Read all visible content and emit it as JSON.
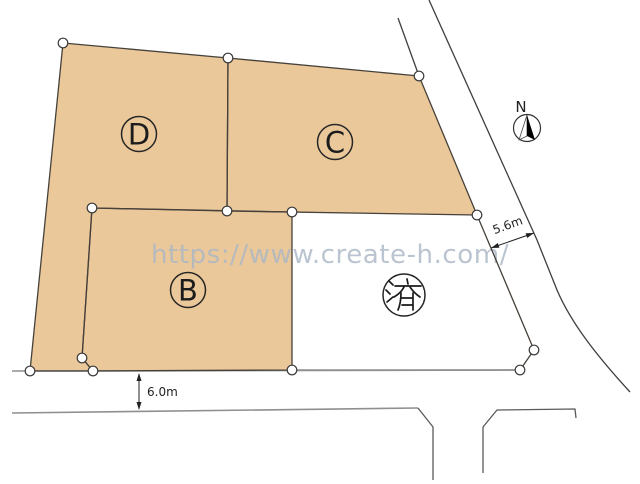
{
  "watermark": {
    "text": "https://www.create-h.com/"
  },
  "compass": {
    "label": "N"
  },
  "lots": [
    {
      "id": "D",
      "label": "D"
    },
    {
      "id": "C",
      "label": "C"
    },
    {
      "id": "B",
      "label": "B"
    },
    {
      "id": "sold",
      "label": "済"
    }
  ],
  "dimensions": {
    "road_front": {
      "label": "5.6m"
    },
    "road_bottom": {
      "label": "6.0m"
    }
  },
  "colors": {
    "lot_fill": "#eac89a",
    "lot_outline": "#46413a",
    "road_line_gray": "#8f8f8f",
    "road_line_dark": "#3f3f3f",
    "sold_lot_fill": "#ffffff",
    "watermark_text": "#aab6c6",
    "dimension_text": "#222222"
  }
}
